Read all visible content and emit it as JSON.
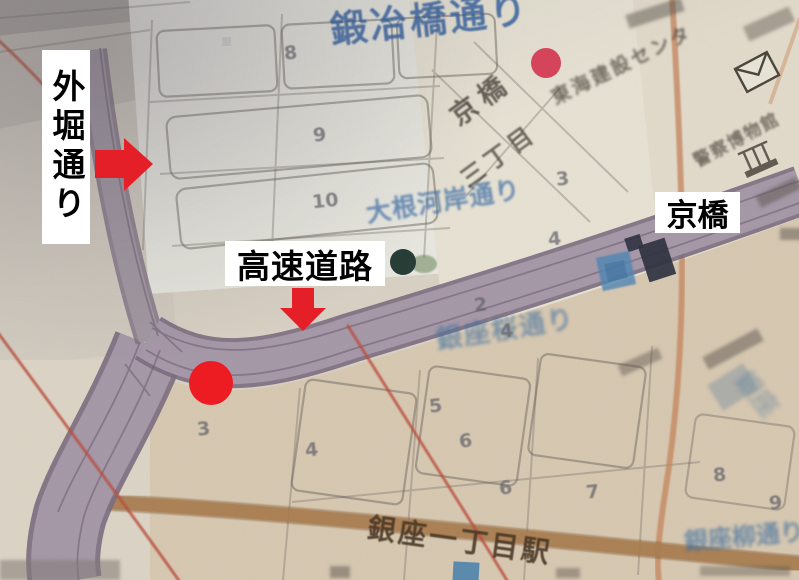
{
  "annotations": {
    "sotobori_dori_label": "外堀通り",
    "expressway_label": "高速道路",
    "kyobashi_label": "京橋",
    "arrow_color": "#e41f27",
    "marker_dot_color": "#ed1c23",
    "small_dot_color": "#d4455c"
  },
  "map": {
    "road_names": {
      "kajibashi_dori": "鍛冶橋通り",
      "daikongashi_dori": "大根河岸通り",
      "ginza_sakura_dori": "銀座桜通り",
      "ginza_yanagi_dori": "銀座柳通り",
      "ginza_vertical": "銀座"
    },
    "place_names": {
      "kyobashi_chome_line1": "京橋",
      "kyobashi_chome_line2": "三丁目",
      "tokai_building": "東海建設センタ",
      "police_museum": "警察博物館",
      "ginza_itchome_station": "銀座一丁目駅"
    },
    "block_numbers": [
      {
        "text": "8",
        "x": 284,
        "y": 42
      },
      {
        "text": "9",
        "x": 313,
        "y": 124
      },
      {
        "text": "10",
        "x": 312,
        "y": 190
      },
      {
        "text": "3",
        "x": 556,
        "y": 168
      },
      {
        "text": "4",
        "x": 548,
        "y": 228
      },
      {
        "text": "2",
        "x": 474,
        "y": 294
      },
      {
        "text": "4",
        "x": 500,
        "y": 320
      },
      {
        "text": "3",
        "x": 197,
        "y": 418
      },
      {
        "text": "4",
        "x": 305,
        "y": 439
      },
      {
        "text": "5",
        "x": 429,
        "y": 395
      },
      {
        "text": "6",
        "x": 459,
        "y": 430
      },
      {
        "text": "6",
        "x": 499,
        "y": 477
      },
      {
        "text": "7",
        "x": 586,
        "y": 481
      },
      {
        "text": "8",
        "x": 713,
        "y": 464
      },
      {
        "text": "9",
        "x": 769,
        "y": 492
      }
    ],
    "icons": {
      "post_office": "envelope-icon",
      "museum": "building-icon",
      "kyobashi_station_marker": "subway-entrance-icon",
      "station_building": "dark-building-icon",
      "poi_dot": "green-poi-icon",
      "ginza_itchome_marker": "subway-entrance-icon"
    },
    "colors": {
      "highway_fill": "#a698a8",
      "highway_edge": "#7b6c80",
      "brown_road": "#ad7e4e",
      "orange_road": "#c9895e",
      "red_boundary": "#c04838",
      "blue_road_text": "#3b6ba4"
    }
  }
}
